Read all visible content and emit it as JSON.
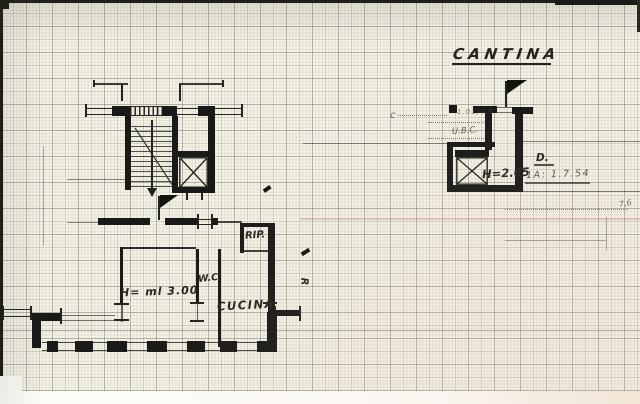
{
  "scan": {
    "title": "CANTINA",
    "apartment": {
      "room_storage": "RIP.",
      "room_wc": "W.C",
      "room_kitchen": "CUCINA",
      "ceiling_height": "H= ml 3.00",
      "side_mark": "R"
    },
    "cellar": {
      "ceiling_height": "H=2.65",
      "ref_letter": "D.",
      "ref_note": "1A: 1.7.54",
      "margin_note_top": "1.01/4.5",
      "margin_note": "U.B.C.",
      "curve_mark": "c",
      "measure_mark": "7,6"
    }
  },
  "colors": {
    "ink": "#1c1c1c",
    "paper": "#f6f2e7",
    "grid": "#aab3a0",
    "red_line": "#cf8d8d"
  }
}
